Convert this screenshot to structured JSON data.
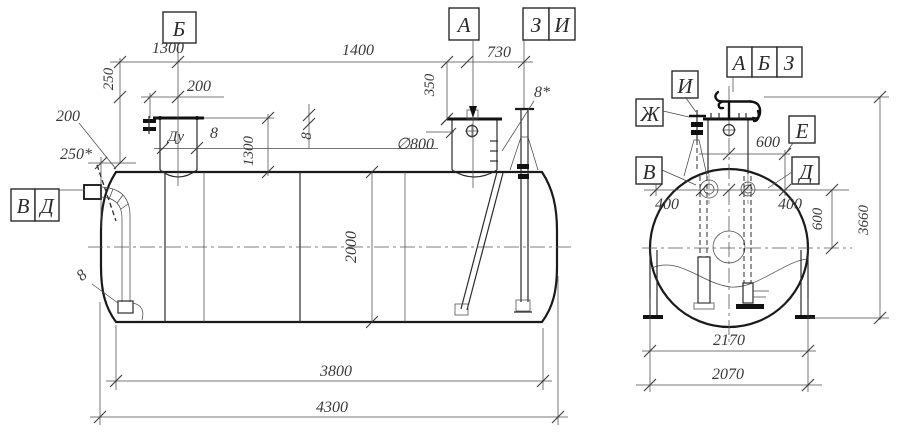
{
  "labels": {
    "a": "А",
    "b": "Б",
    "v": "В",
    "d": "Д",
    "e": "Е",
    "zh": "Ж",
    "z": "З",
    "i": "И",
    "du": "Ду"
  },
  "dims": {
    "top_1300": "1300",
    "top_1400": "1400",
    "top_730": "730",
    "v_250": "250",
    "h_200": "200",
    "leader_200": "200",
    "star_250": "250*",
    "nozzle_8": "8",
    "nozzle_v1300": "1300",
    "manhole_350": "350",
    "manhole_dia": "∅800",
    "shell_8": "8",
    "vent_8star": "8*",
    "diam_2000": "2000",
    "cone_8": "8",
    "len_3800": "3800",
    "len_4300": "4300",
    "end_600h": "600",
    "end_400l": "400",
    "end_400r": "400",
    "end_600v": "600",
    "end_3660": "3660",
    "end_2170": "2170",
    "end_2070": "2070"
  }
}
